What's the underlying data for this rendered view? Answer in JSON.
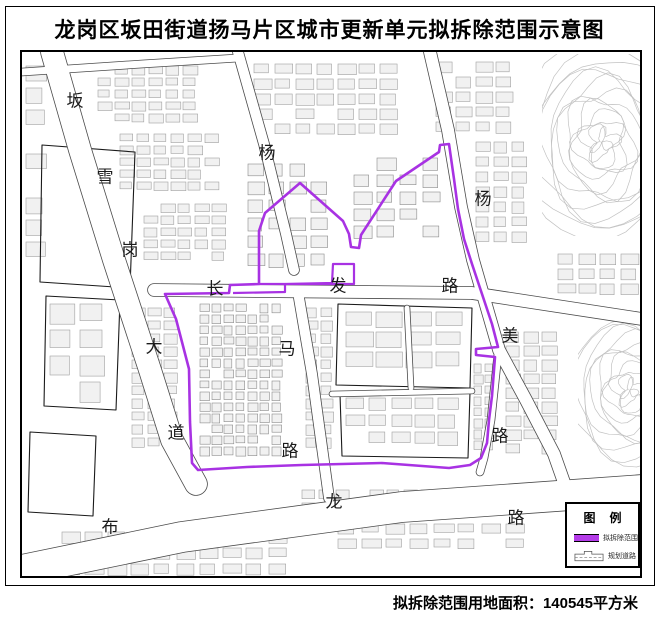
{
  "title": "龙岗区坂田街道扬马片区城市更新单元拟拆除范围示意图",
  "footer": {
    "area_text": "拟拆除范围用地面积：140545平方米"
  },
  "legend": {
    "title": "图例",
    "items": [
      {
        "name": "demolition-boundary",
        "label": "拟拆除范围",
        "color": "#b43ce8"
      },
      {
        "name": "planned-road",
        "label": "规划道路"
      }
    ]
  },
  "map": {
    "colors": {
      "boundary": "#a832e3",
      "building_fill": "#f1f1f1",
      "building_stroke": "#a0a0a0",
      "road_casing": "#4a4a4a",
      "parcel_outline": "#1a1a1a",
      "contour": "#c2c2c2",
      "label": "#1a1a1a"
    },
    "road_labels": [
      {
        "t": "坂",
        "x": 73,
        "y": 99
      },
      {
        "t": "雪",
        "x": 103,
        "y": 175
      },
      {
        "t": "岗",
        "x": 128,
        "y": 248
      },
      {
        "t": "大",
        "x": 152,
        "y": 345
      },
      {
        "t": "道",
        "x": 174,
        "y": 431
      },
      {
        "t": "杨",
        "x": 265,
        "y": 151
      },
      {
        "t": "长",
        "x": 213,
        "y": 287
      },
      {
        "t": "发",
        "x": 336,
        "y": 284
      },
      {
        "t": "路",
        "x": 448,
        "y": 284
      },
      {
        "t": "马",
        "x": 285,
        "y": 347
      },
      {
        "t": "路",
        "x": 288,
        "y": 449
      },
      {
        "t": "杨",
        "x": 481,
        "y": 197
      },
      {
        "t": "美",
        "x": 508,
        "y": 334
      },
      {
        "t": "路",
        "x": 498,
        "y": 434
      },
      {
        "t": "布",
        "x": 108,
        "y": 525
      },
      {
        "t": "龙",
        "x": 332,
        "y": 500
      },
      {
        "t": "路",
        "x": 514,
        "y": 516
      }
    ],
    "boundary_main": "M 163,292 L 227,291 L 228,283 L 257,282 L 257,229 L 263,211 L 298,181 L 341,219 L 347,232 L 349,245 L 357,246 L 359,233 L 394,179 L 437,150 L 438,143 L 447,142 L 452,177 L 456,207 L 462,237 L 470,262 L 480,292 L 490,322 L 496,345 L 474,347 L 474,353 L 493,355 L 490,394 L 487,418 L 485,441 L 479,456 L 468,463 L 447,466 L 380,461 L 300,463 L 245,465 L 196,468 L 190,461 L 188,420 L 187,367 L 174,317 Z",
    "boundary_detail": "M 231,291 L 283,290 L 283,282 L 330,281 L 331,262 L 352,262 L 352,282 L 257,282",
    "roads": [
      {
        "name": "banxuegang-dadao",
        "d": "M 50,50 L 78,148 L 112,258 L 148,368 L 170,438 L 194,482",
        "w": 22
      },
      {
        "name": "bulong-lu",
        "d": "M 20,568 L 180,535 L 400,505 L 640,488",
        "w": 30
      },
      {
        "name": "changfa-lu",
        "d": "M 152,288 L 470,291 L 640,317",
        "w": 12
      },
      {
        "name": "yangma-lu-north",
        "d": "M 236,50 L 262,142 L 284,232 L 292,268",
        "w": 10
      },
      {
        "name": "yangma-lu-south",
        "d": "M 297,296 L 310,372 L 319,438 L 327,496",
        "w": 10
      },
      {
        "name": "yangmei-lu",
        "d": "M 428,50 L 446,128 L 459,205 L 471,258 L 486,310 L 497,348 L 524,398 L 552,452 L 564,486",
        "w": 12
      },
      {
        "name": "yangmei-branch",
        "d": "M 496,352 L 489,418 L 482,456 L 478,470",
        "w": 7
      },
      {
        "name": "top-road",
        "d": "M 20,70 L 140,62 L 236,56",
        "w": 7
      },
      {
        "name": "lane-1",
        "d": "M 330,392 L 470,389",
        "w": 5
      },
      {
        "name": "lane-2",
        "d": "M 405,306 L 409,386",
        "w": 5
      }
    ],
    "parcels": [
      "M 40,143 L 133,150 L 128,286 L 38,280 Z",
      "M 44,294 L 118,298 L 114,408 L 42,404 Z",
      "M 28,430 L 94,434 L 91,514 L 26,510 Z",
      "M 336,302 L 470,306 L 468,386 L 334,383 Z",
      "M 338,392 L 468,390 L 466,456 L 340,454 Z"
    ],
    "building_blocks": [
      {
        "x": 96,
        "y": 64,
        "w": 112,
        "h": 60,
        "cw": 13,
        "ch": 8,
        "g": 4
      },
      {
        "x": 118,
        "y": 132,
        "w": 104,
        "h": 62,
        "cw": 13,
        "ch": 8,
        "g": 4
      },
      {
        "x": 142,
        "y": 202,
        "w": 94,
        "h": 64,
        "cw": 13,
        "ch": 8,
        "g": 4
      },
      {
        "x": 252,
        "y": 62,
        "w": 156,
        "h": 72,
        "cw": 16,
        "ch": 10,
        "g": 5
      },
      {
        "x": 434,
        "y": 60,
        "w": 84,
        "h": 70,
        "cw": 15,
        "ch": 10,
        "g": 5
      },
      {
        "x": 474,
        "y": 140,
        "w": 58,
        "h": 100,
        "cw": 13,
        "ch": 10,
        "g": 5
      },
      {
        "x": 246,
        "y": 162,
        "w": 94,
        "h": 102,
        "cw": 15,
        "ch": 12,
        "g": 6,
        "s": "#8a8a8a"
      },
      {
        "x": 352,
        "y": 156,
        "w": 94,
        "h": 94,
        "cw": 17,
        "ch": 11,
        "g": 6,
        "s": "#8a8a8a"
      },
      {
        "x": 24,
        "y": 64,
        "w": 24,
        "h": 200,
        "cw": 18,
        "ch": 14,
        "g": 8
      },
      {
        "x": 198,
        "y": 302,
        "w": 92,
        "h": 156,
        "cw": 9,
        "ch": 8,
        "g": 3,
        "s": "#8a8a8a"
      },
      {
        "x": 130,
        "y": 306,
        "w": 58,
        "h": 148,
        "cw": 12,
        "ch": 9,
        "g": 4
      },
      {
        "x": 304,
        "y": 306,
        "w": 26,
        "h": 148,
        "cw": 11,
        "ch": 9,
        "g": 4
      },
      {
        "x": 344,
        "y": 310,
        "w": 116,
        "h": 68,
        "cw": 24,
        "ch": 14,
        "g": 6
      },
      {
        "x": 344,
        "y": 396,
        "w": 116,
        "h": 56,
        "cw": 18,
        "ch": 12,
        "g": 5
      },
      {
        "x": 472,
        "y": 362,
        "w": 20,
        "h": 92,
        "cw": 8,
        "ch": 8,
        "g": 3
      },
      {
        "x": 504,
        "y": 330,
        "w": 54,
        "h": 128,
        "cw": 14,
        "ch": 10,
        "g": 4
      },
      {
        "x": 556,
        "y": 252,
        "w": 80,
        "h": 42,
        "cw": 16,
        "ch": 10,
        "g": 5
      },
      {
        "x": 48,
        "y": 302,
        "w": 64,
        "h": 98,
        "cw": 22,
        "ch": 18,
        "g": 8
      },
      {
        "x": 60,
        "y": 530,
        "w": 230,
        "h": 42,
        "cw": 17,
        "ch": 10,
        "g": 6
      },
      {
        "x": 300,
        "y": 488,
        "w": 230,
        "h": 26,
        "cw": 13,
        "ch": 9,
        "g": 4
      },
      {
        "x": 336,
        "y": 522,
        "w": 200,
        "h": 30,
        "cw": 18,
        "ch": 9,
        "g": 6
      }
    ],
    "contour_patches": [
      {
        "x": 540,
        "y": 52,
        "w": 98,
        "h": 182,
        "cx": 600,
        "cy": 140,
        "n": 13,
        "r0": 6,
        "dr": 5.5,
        "wob": 5
      },
      {
        "x": 576,
        "y": 300,
        "w": 62,
        "h": 168,
        "cx": 628,
        "cy": 388,
        "n": 11,
        "r0": 5,
        "dr": 5,
        "wob": 4
      }
    ]
  }
}
